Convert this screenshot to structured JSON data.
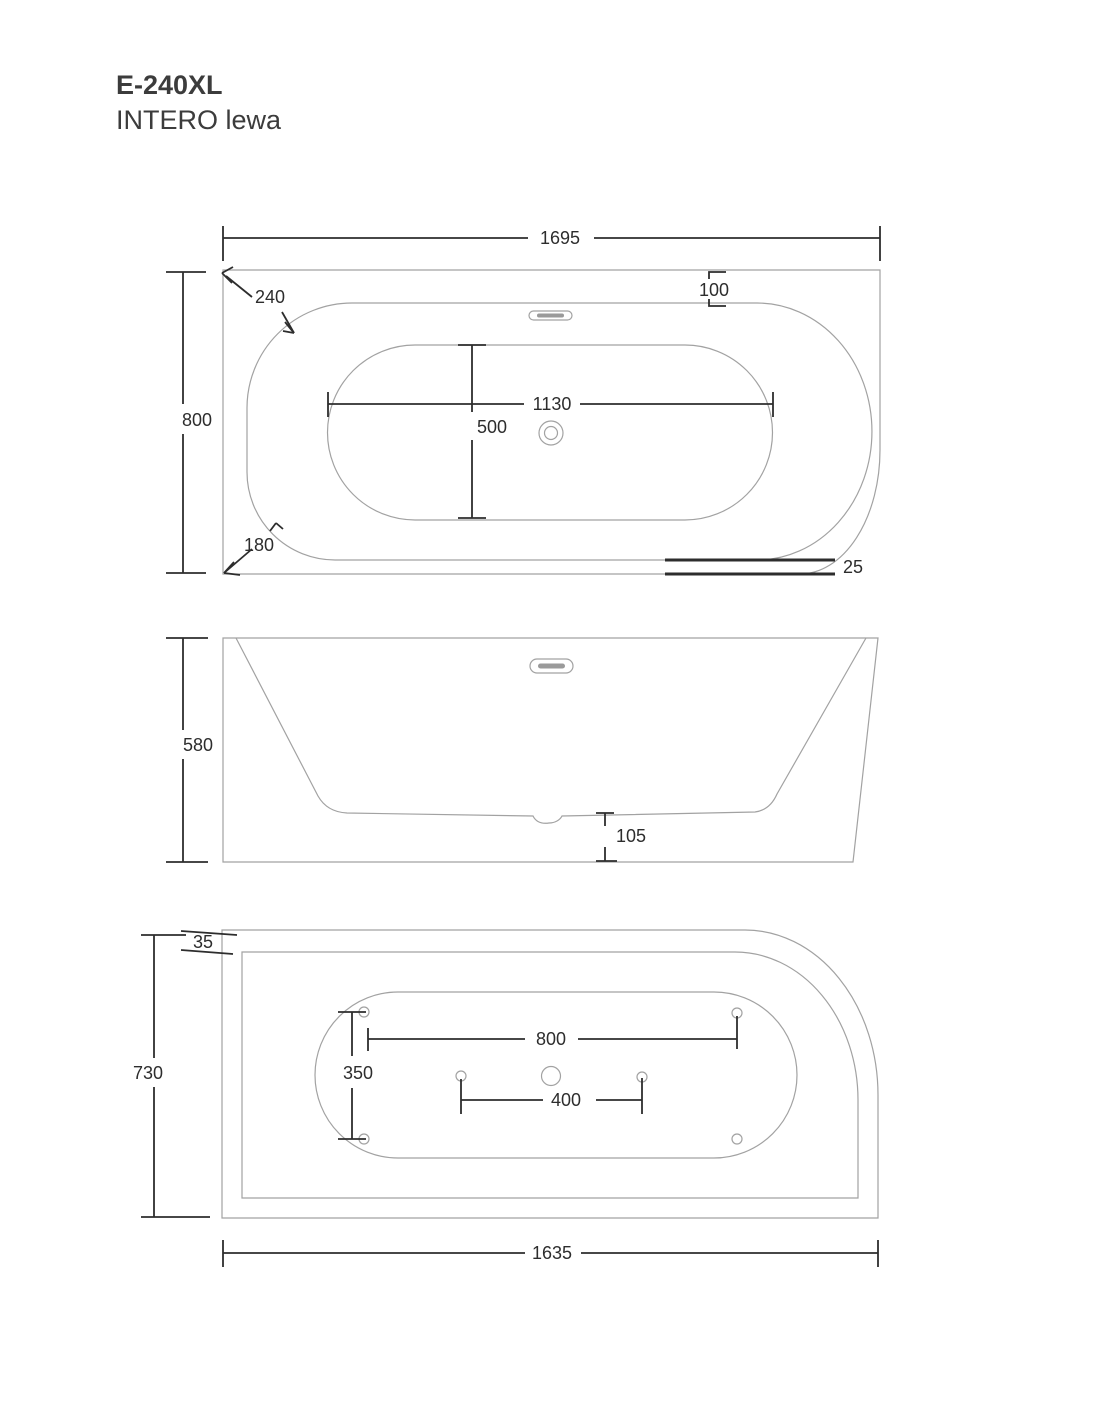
{
  "title": {
    "model": "E-240XL",
    "variant": "INTERO lewa"
  },
  "colors": {
    "thin_line": "#a2a2a2",
    "dim_line": "#2d2d2d",
    "text": "#3c3c3c",
    "background": "#ffffff"
  },
  "views": {
    "top": {
      "dims": {
        "overall_length": "1695",
        "overall_width": "800",
        "corner_radius_top": "240",
        "corner_radius_bottom": "180",
        "basin_length": "1130",
        "basin_width": "500",
        "edge_inset": "100",
        "apron_offset": "25"
      }
    },
    "side": {
      "dims": {
        "height": "580",
        "base_clearance": "105"
      }
    },
    "bottom": {
      "dims": {
        "overall_width": "730",
        "rim_offset": "35",
        "feet_span_length": "800",
        "feet_span_width": "350",
        "drain_feet_span": "400",
        "base_length": "1635"
      }
    }
  }
}
